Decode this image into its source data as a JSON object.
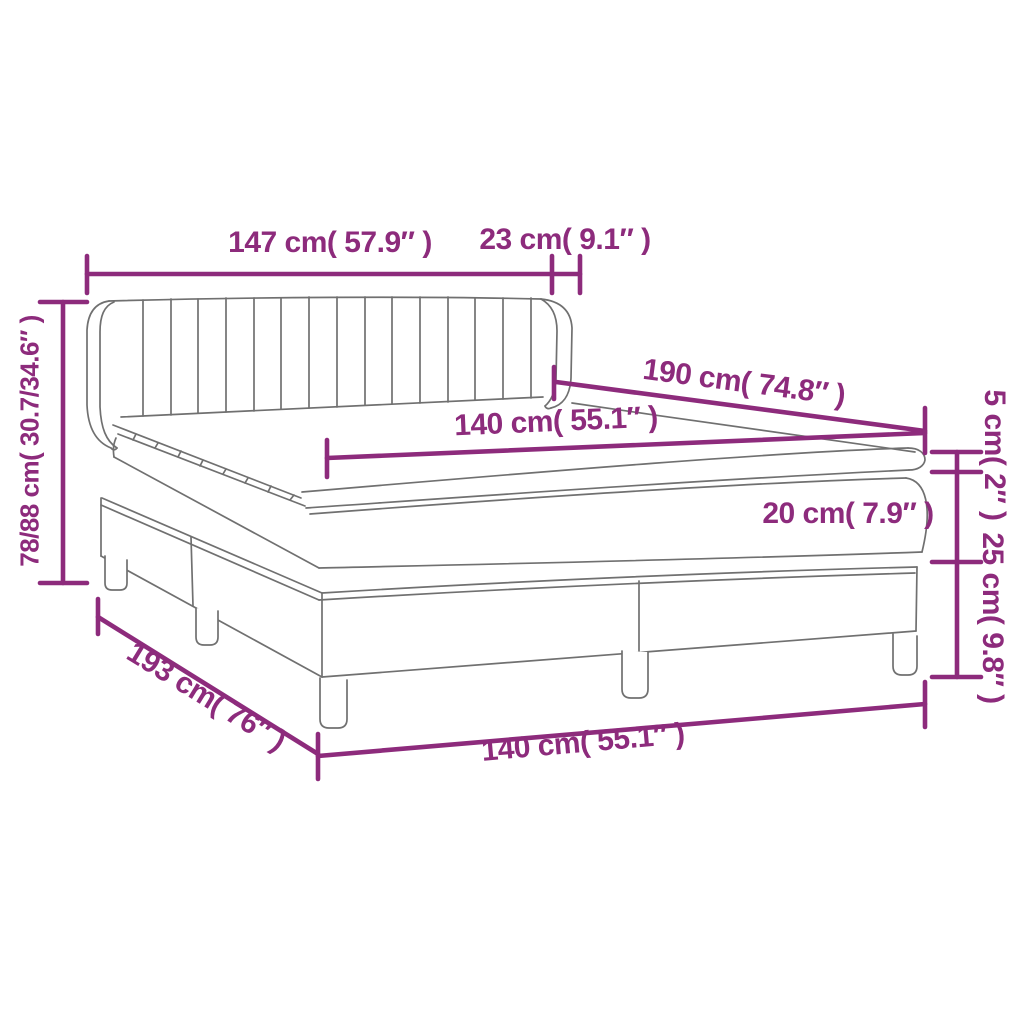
{
  "colors": {
    "dimension_accent": "#8d2b7c",
    "line_art": "#707070",
    "background": "#ffffff"
  },
  "diagram": {
    "dimensions": {
      "headboard_width": "147 cm( 57.9″ )",
      "headboard_side_depth": "23 cm( 9.1″ )",
      "overall_height": "78/88 cm( 30.7/34.6″ )",
      "bed_length": "190 cm( 74.8″ )",
      "mattress_width": "140 cm( 55.1″ )",
      "topper_thickness": "5 cm( 2″ )",
      "mattress_thickness": "20 cm( 7.9″ )",
      "base_height": "25 cm( 9.8″ )",
      "base_length": "193 cm( 76″ )",
      "base_width": "140 cm( 55.1″ )"
    }
  }
}
